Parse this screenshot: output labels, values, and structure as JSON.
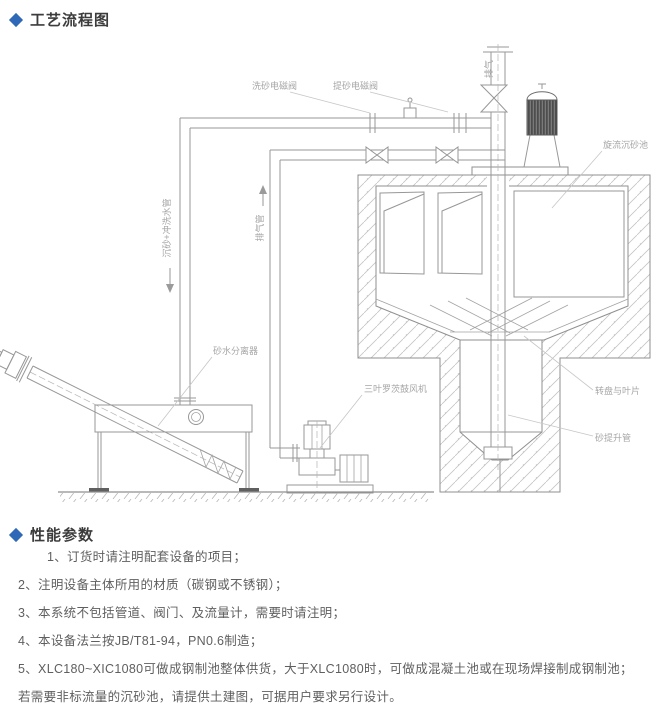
{
  "page": {
    "accent_color": "#3068b8"
  },
  "sections": {
    "process_flow": {
      "title": "工艺流程图"
    },
    "performance": {
      "title": "性能参数"
    }
  },
  "diagram": {
    "labels": {
      "wash_valve": "洗砂电磁阀",
      "lift_valve": "提砂电磁阀",
      "exhaust": "排气",
      "cyclone_tank": "旋流沉砂池",
      "grit_wash_pipe": "沉砂+冲洗水管",
      "air_pipe": "排气管",
      "separator": "砂水分离器",
      "blower": "三叶罗茨鼓风机",
      "turntable": "转盘与叶片",
      "sand_lift_pipe": "砂提升管"
    }
  },
  "notes": [
    "1、订货时请注明配套设备的项目；",
    "2、注明设备主体所用的材质（碳钢或不锈钢）；",
    "3、本系统不包括管道、阀门、及流量计，需要时请注明；",
    "4、本设备法兰按JB/T81-94，PN0.6制造；",
    "5、XLC180~XIC1080可做成钢制池整体供货，大于XLC1080时，可做成混凝土池或在现场焊接制成钢制池；",
    "若需要非标流量的沉砂池，请提供土建图，可据用户要求另行设计。"
  ]
}
